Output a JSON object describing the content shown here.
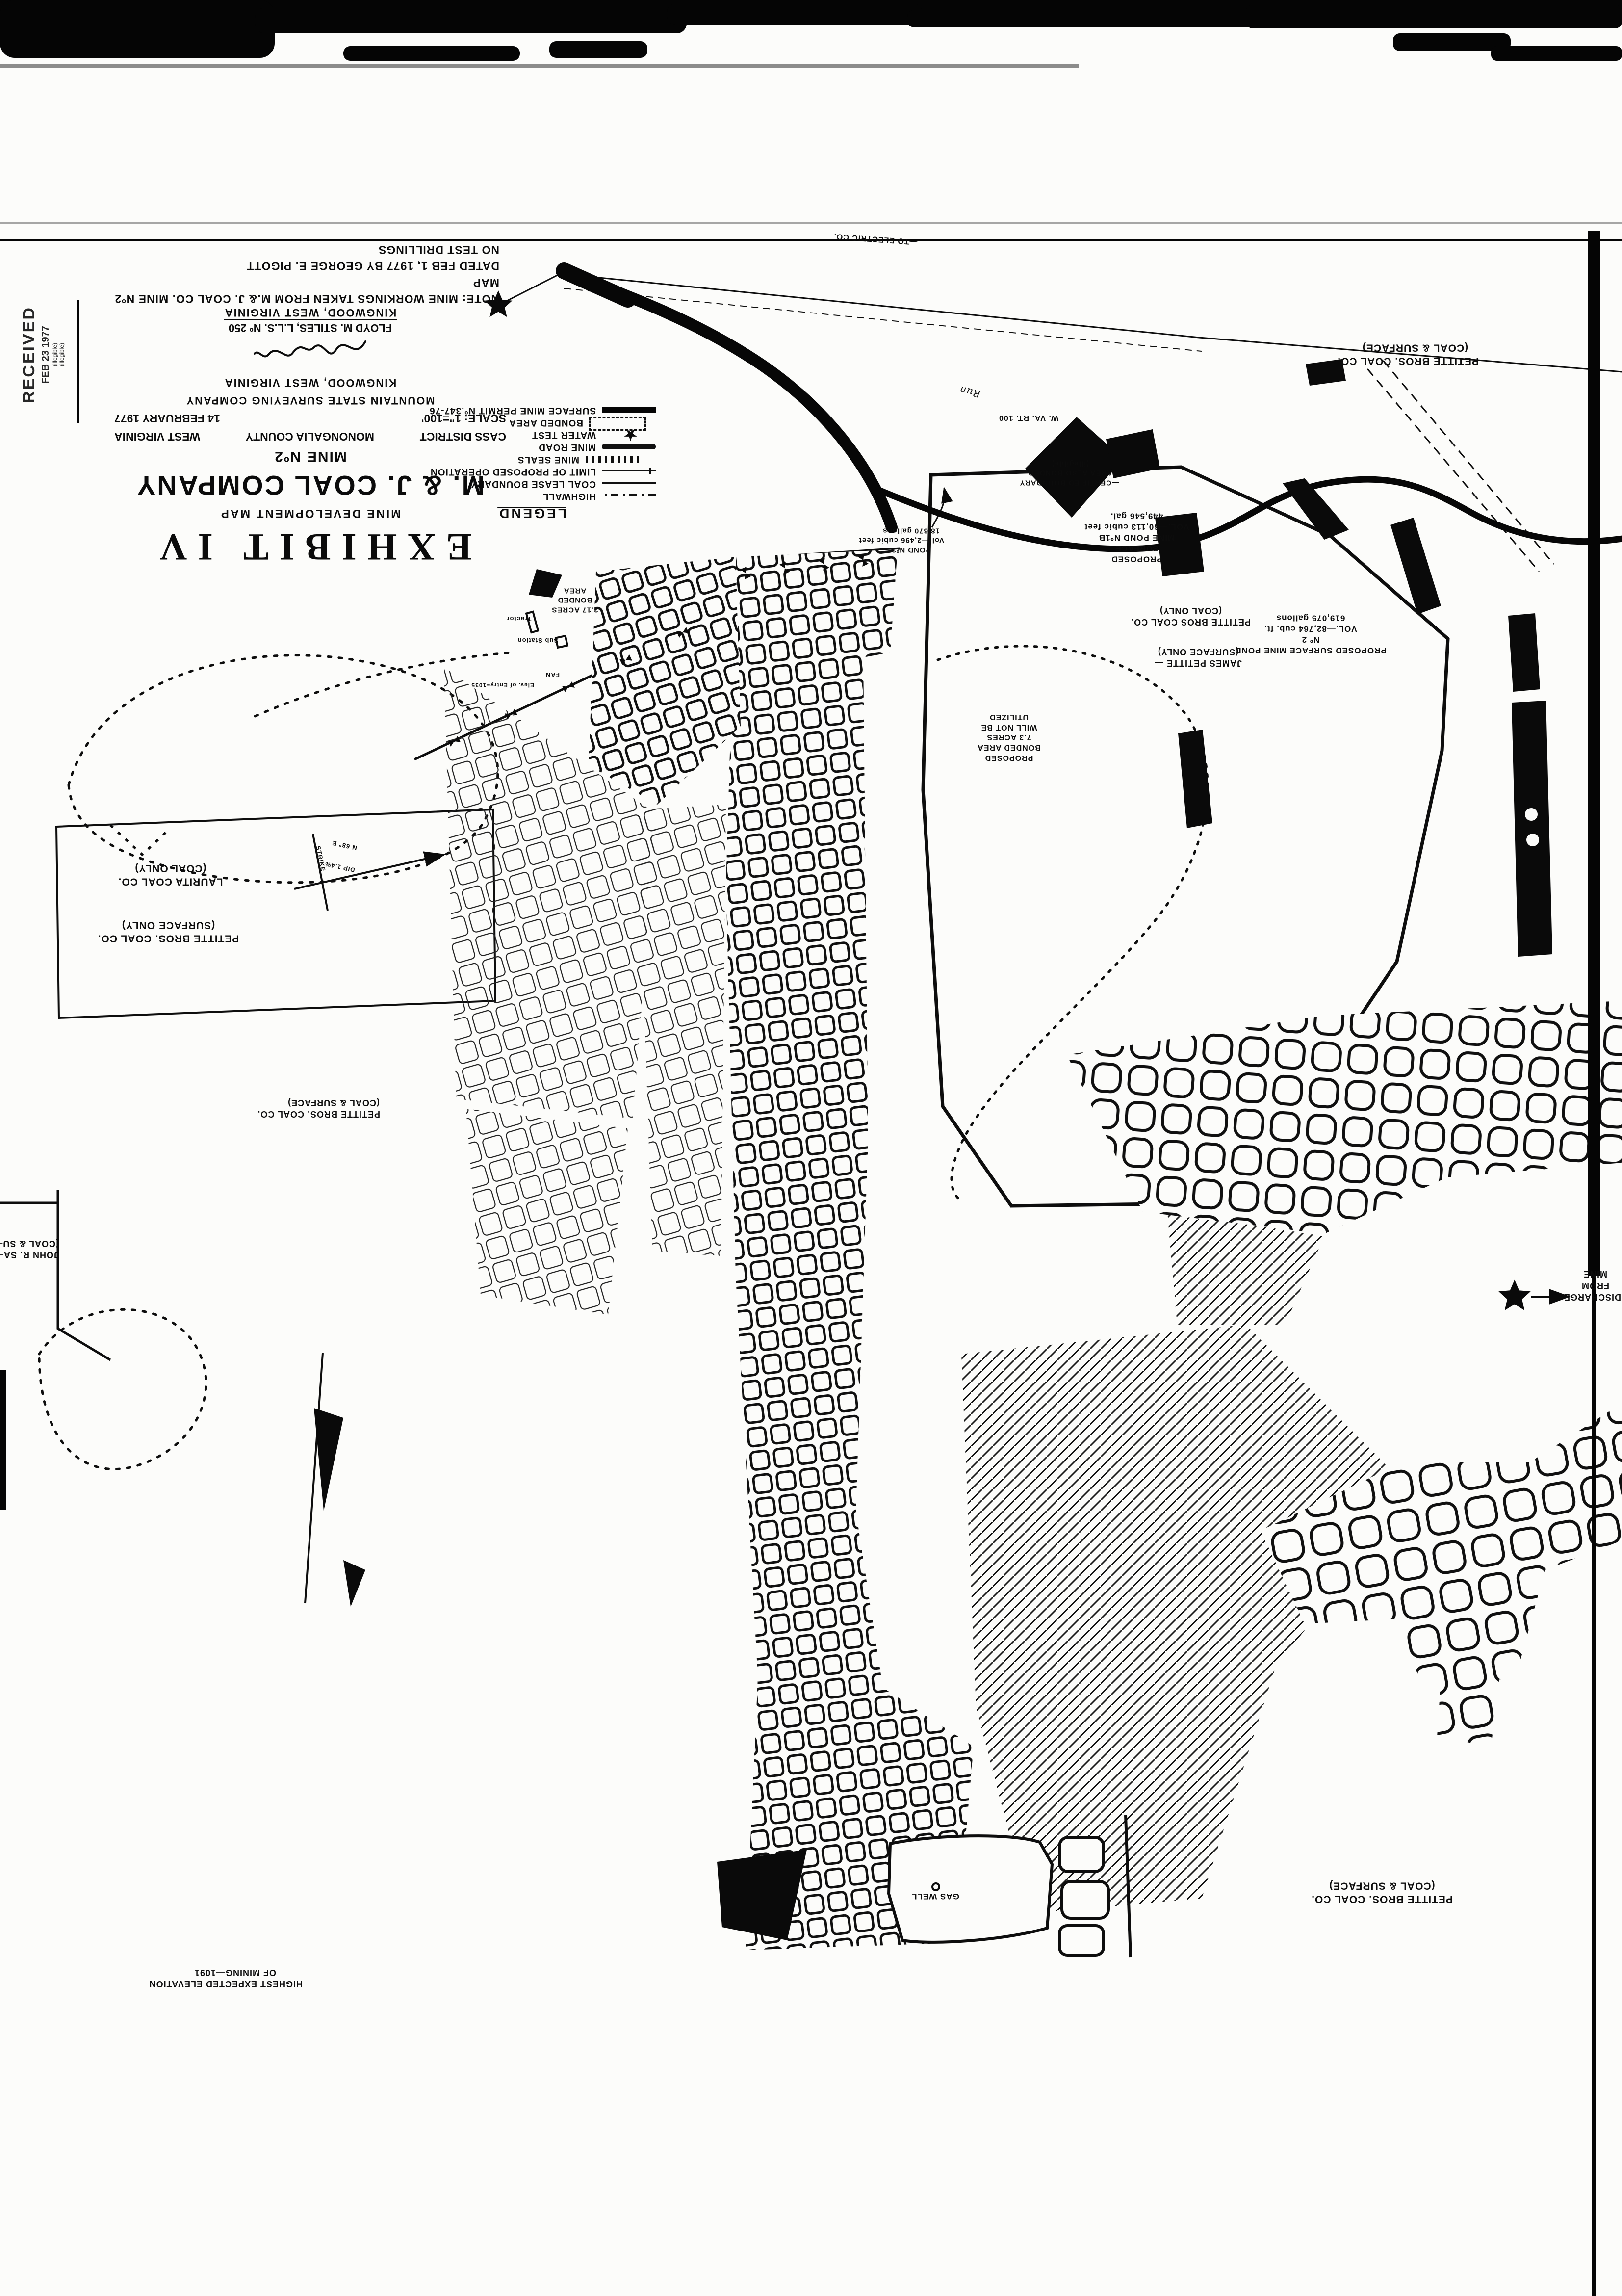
{
  "colors": {
    "ink": "#0b0b0b",
    "paper": "#fcfcfa"
  },
  "sheet": {
    "note_lines": [
      "NOTE: MINE WORKINGS TAKEN FROM M.& J. COAL CO. MINE Nº2 MAP",
      "DATED FEB 1, 1977 BY GEORGE E. PIGOTT",
      "NO TEST DRILLINGS"
    ],
    "stamp_lines": [
      "RECEIVED",
      "FEB 23 1977",
      "(illegible)",
      "(illegible)"
    ]
  },
  "title_block": {
    "exhibit": "EXHIBIT IV",
    "map_type": "MINE DEVELOPMENT MAP",
    "company": "M. & J. COAL COMPANY",
    "mine": "MINE Nº2",
    "district": "CASS DISTRICT",
    "county": "MONONGALIA COUNTY",
    "state": "WEST VIRGINIA",
    "scale": "SCALE: 1\"=100'",
    "date": "14 FEBRUARY 1977",
    "firm": "MOUNTAIN STATE SURVEYING COMPANY",
    "firm_city": "KINGWOOD, WEST VIRGINIA",
    "surveyor": "FLOYD M. STILES, L.L.S. Nº 250",
    "surveyor_city": "KINGWOOD, WEST VIRGINIA"
  },
  "legend": {
    "title": "LEGEND",
    "items": [
      {
        "label": "HIGHWALL",
        "symbol": "dashdot"
      },
      {
        "label": "COAL LEASE BOUNDARY",
        "symbol": "solid"
      },
      {
        "label": "LIMIT OF PROPOSED OPERATION",
        "symbol": "limit"
      },
      {
        "label": "MINE SEALS",
        "symbol": "seals"
      },
      {
        "label": "MINE ROAD",
        "symbol": "road"
      },
      {
        "label": "WATER TEST",
        "symbol": "star"
      },
      {
        "label": "BONDED AREA",
        "symbol": "dashedbox"
      },
      {
        "label": "SURFACE MINE PERMIT Nº.347-76",
        "symbol": "heavy"
      }
    ]
  },
  "parcels": [
    {
      "owner": "PETITTE BROS. COAL CO.",
      "rights": "(COAL & SURFACE)"
    },
    {
      "owner": "PETITTE BROS COAL CO.",
      "rights": "(COAL ONLY)"
    },
    {
      "owner": "JAMES PETITTE —",
      "rights": "(SURFACE ONLY)"
    },
    {
      "owner": "LAURITA COAL CO.",
      "rights": "(COAL ONLY)"
    },
    {
      "owner": "PETITTE BROS. COAL CO.",
      "rights": "(SURFACE ONLY)"
    },
    {
      "owner": "PETITTE BROS. COAL CO.",
      "rights": "(COAL & SURFACE)"
    },
    {
      "owner": "JOHN R. SA—",
      "rights": "(COAL & SU—"
    },
    {
      "owner": "PETITTE BROS. COAL CO.",
      "rights": "(COAL & SURFACE)"
    }
  ],
  "ponds": {
    "pond3_lines": [
      "POND Nº3",
      "Vol.—2,496 cubic feet",
      "18,670 gallons"
    ],
    "pond1b_lines": [
      "PROPOSED",
      "SURFACE",
      "MINE POND Nº1B",
      "VOL.—60,113 cubic feet",
      "449,546 gal."
    ],
    "pond2_lines": [
      "PROPOSED SURFACE MINE POND",
      "Nº 2",
      "VOL.—82,764 cub. ft.",
      "619,075 gallons"
    ]
  },
  "annotations": {
    "discharge_lines": [
      "DISCHARGE",
      "FROM",
      "MINE"
    ],
    "gas_well": "GAS WELL",
    "highest_lines": [
      "HIGHEST EXPECTED ELEVATION",
      "OF MINING—1091"
    ],
    "bonded217_lines": [
      "2.17 ACRES",
      "BONDED",
      "AREA"
    ],
    "tractor": "Tractor",
    "substation": "Sub Station",
    "fan": "FAN",
    "entry_elev": "Elev. of Entry=1035",
    "proposed_bonded_lines": [
      "PROPOSED",
      "BONDED AREA",
      "7.3 ACRES",
      "WILL NOT BE",
      "UTILIZED"
    ],
    "certified_lines": [
      "—CERTIFIED BOUNDARY",
      "AREA ALSO BONDED",
      "(illegible)"
    ],
    "route": "W. VA. RT. 100",
    "electric": "—TO ELECTRIC CO.",
    "stream": "Run",
    "strike": "STRIKE",
    "bearing": "N 68° E",
    "dip": "DIP 1.4%"
  }
}
